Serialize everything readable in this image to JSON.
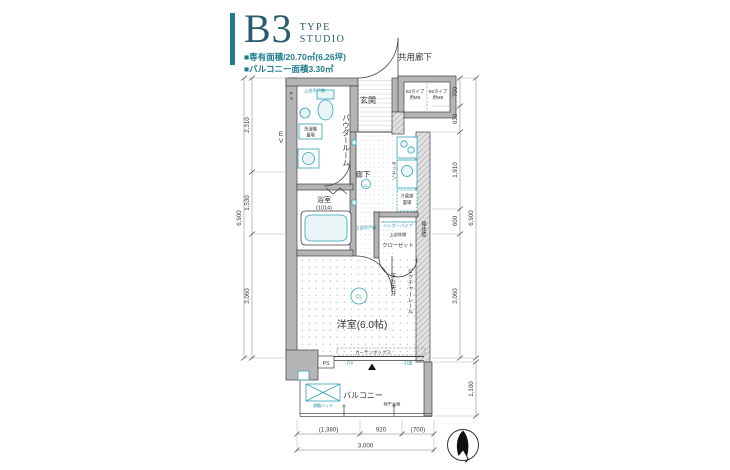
{
  "header": {
    "type_code": "B3",
    "type_word": "TYPE",
    "studio_word": "STUDIO",
    "area_line": "■専有面積/20.70㎡(6.26坪)",
    "balcony_line": "■バルコニー面積3.30㎡"
  },
  "plan": {
    "rooms": {
      "shared_corridor": "共用廊下",
      "entrance": "玄関",
      "powder_room": "パウダールーム",
      "hallway": "廊下",
      "bathroom": "浴室",
      "bathroom_size": "(1014)",
      "western_room": "洋室(6.0帖)",
      "closet": "クローゼット",
      "balcony": "バルコニー",
      "elevator": "EV"
    },
    "fixtures": {
      "mb_left_line1": "B3タイプ",
      "mb_left_line2": "用MB",
      "mb_right_line1": "B2タイプ",
      "mb_right_line2": "用MB",
      "ps_top": "PS",
      "ps_bottom": "PS",
      "washer_line1": "洗濯機",
      "washer_line2": "置場",
      "fridge_line1": "冷蔵庫",
      "fridge_line2": "置場",
      "kitchen": "キッチン",
      "upper_cabinet_1": "上部吊戸棚",
      "upper_cabinet_2": "上部吊戸棚",
      "hanger_pipe": "ハンガーパイプ",
      "upper_shelf": "上部枕棚",
      "picture_rail": "ピクチャーレール",
      "dropped_ceiling": "下り天井",
      "structural_wall": "躯体壁",
      "curtain_box": "カーテンボックス",
      "laundry_hook": "物干金物",
      "escape_hatch": "避難ハッチ",
      "window_fix": "→FIX",
      "window_sliding": "→引違",
      "ceiling_light": "CL"
    },
    "dimensions": {
      "left": [
        "2,310",
        "1,530",
        "3,060"
      ],
      "left_total": "6,900",
      "right": [
        "700",
        "630",
        "1,910",
        "600",
        "3,060"
      ],
      "right_total": "6,900",
      "balcony_depth": "1,100",
      "bottom": [
        "(1,380)",
        "920",
        "(700)"
      ],
      "bottom_total": "3,000"
    }
  },
  "colors": {
    "accent_teal": "#1e7c8c",
    "fixture_teal": "#2fa3b7",
    "heading_teal": "#2a5a6e",
    "wall_gray": "#b5b5b5",
    "line_dark": "#3c3c3c"
  }
}
